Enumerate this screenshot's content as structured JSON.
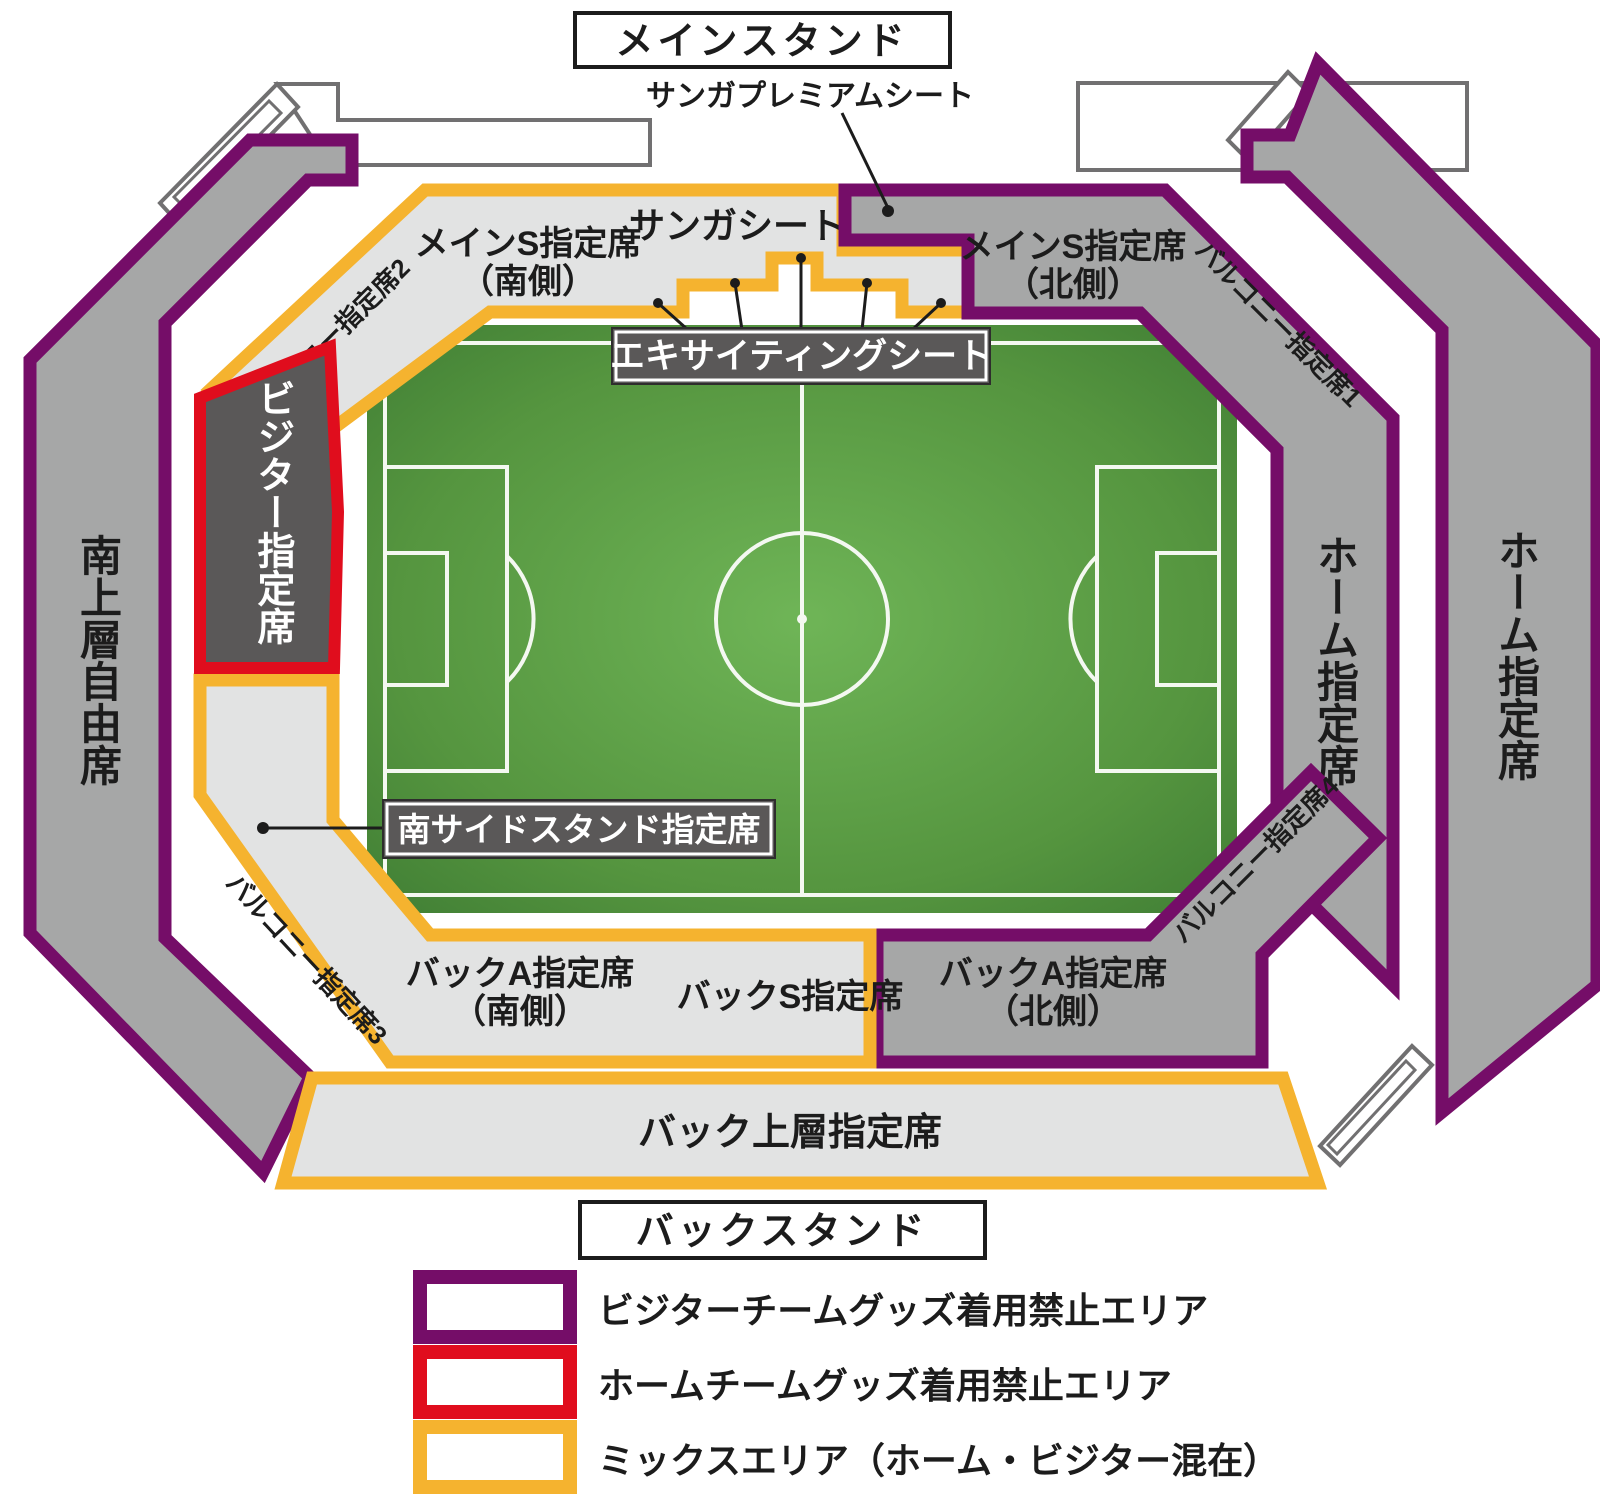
{
  "titles": {
    "main_stand": "メインスタンド",
    "back_stand": "バックスタンド"
  },
  "sections": {
    "sanga_premium": "サンガプレミアムシート",
    "main_s_south": {
      "line1": "メインS指定席",
      "line2": "（南側）"
    },
    "sanga_seat": "サンガシート",
    "main_s_north": {
      "line1": "メインS指定席",
      "line2": "（北側）"
    },
    "exciting_seat": "エキサイティングシート",
    "balcony1": "バルコニー指定席1",
    "balcony2": "バルコニー指定席2",
    "balcony3": "バルコニー指定席3",
    "balcony4": "バルコニー指定席4",
    "visitor": "ビジター指定席",
    "south_upper_free": "南上層自由席",
    "home_inner": "ホーム指定席",
    "home_outer": "ホーム指定席",
    "south_side_stand": "南サイドスタンド指定席",
    "back_a_south": {
      "line1": "バックA指定席",
      "line2": "（南側）"
    },
    "back_s": "バックS指定席",
    "back_a_north": {
      "line1": "バックA指定席",
      "line2": "（北側）"
    },
    "back_upper": "バック上層指定席"
  },
  "legend": [
    {
      "label": "ビジターチームグッズ着用禁止エリア",
      "color": "#750D68"
    },
    {
      "label": "ホームチームグッズ着用禁止エリア",
      "color": "#E00D1D"
    },
    {
      "label": "ミックスエリア（ホーム・ビジター混在）",
      "color": "#F5B32F"
    }
  ],
  "colors": {
    "visitor_ban_purple": "#750D68",
    "home_ban_red": "#E00D1D",
    "mix_yellow": "#F5B32F",
    "stand_gray": "#A6A7A7",
    "seat_light_gray": "#E2E3E3",
    "dark_gray": "#5A5858",
    "pitch_green": "#55953F"
  }
}
